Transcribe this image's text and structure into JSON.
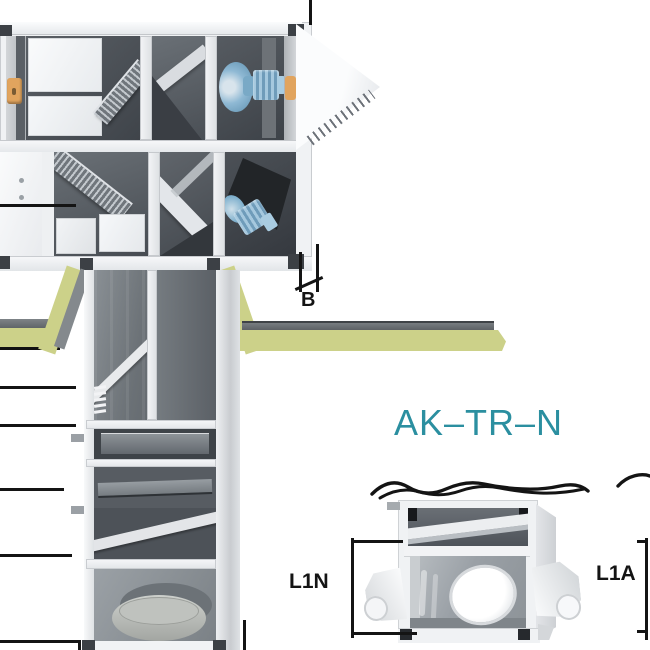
{
  "diagram": {
    "title": {
      "text": "AK–TR–N"
    },
    "dims": {
      "b": "B",
      "l1n": "L1N",
      "l1a": "L1A"
    },
    "colors": {
      "title_teal": "#2b8fa0",
      "line_black": "#141414",
      "insulation_yellow": "#ccd189",
      "slab_gray": "#6a6f73",
      "frame_white": "#f0f2f4",
      "interior_dark": "#4b5056",
      "interior_gray": "#9aa0a6",
      "fan_blue": "#7fb0cd",
      "latch_orange": "#e1a45e"
    }
  }
}
